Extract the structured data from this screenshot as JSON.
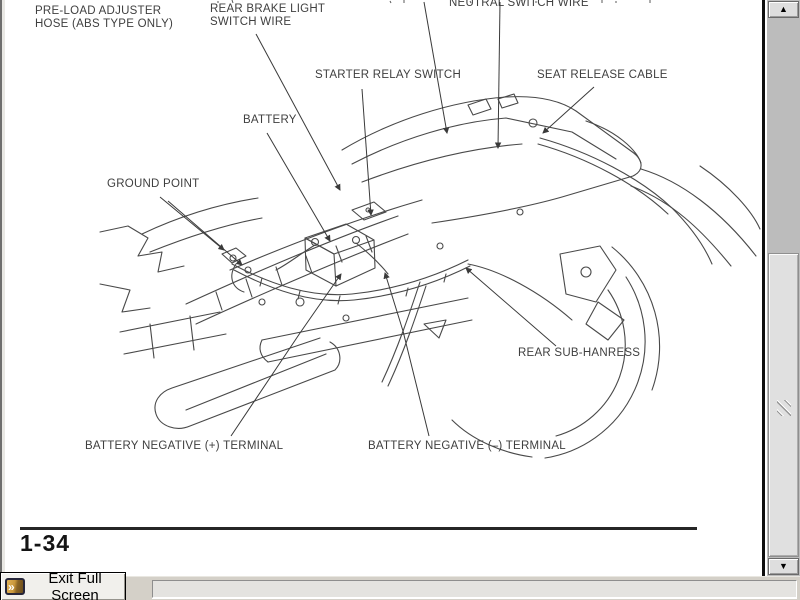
{
  "page": {
    "labels": {
      "shock_absorber_clipped": "SHOCK ABSORBER",
      "preload_adjuster": "PRE-LOAD ADJUSTER",
      "hose_abs": "HOSE (ABS TYPE ONLY)",
      "rear_brake_light": "REAR BRAKE LIGHT",
      "switch_wire": "SWITCH WIRE",
      "neutral_switch_wire": "NEUTRAL SWITCH WIRE",
      "starter_relay_switch": "STARTER RELAY SWITCH",
      "seat_release_cable": "SEAT RELEASE CABLE",
      "battery": "BATTERY",
      "ground_point": "GROUND POINT",
      "rear_subharness": "REAR SUB-HANRESS",
      "battery_terminal_left": "BATTERY NEGATIVE (+) TERMINAL",
      "battery_terminal_right": "BATTERY NEGATIVE (–) TERMINAL"
    },
    "page_number": "1-34"
  },
  "viewer": {
    "exit_button_label": "Exit Full Screen",
    "icons": {
      "scroll_up": "▲",
      "scroll_down": "▼",
      "exit_chevron": "»"
    }
  },
  "colors": {
    "taskbar_bg": "#d4d0c8",
    "scrollbar_track": "#bcbcbc",
    "scrollbar_thumb": "#e0e0e0",
    "page_bg": "#ffffff",
    "ink": "#3a3a3a",
    "exit_icon_gold": "#c8963a",
    "exit_icon_border": "#26263a"
  }
}
